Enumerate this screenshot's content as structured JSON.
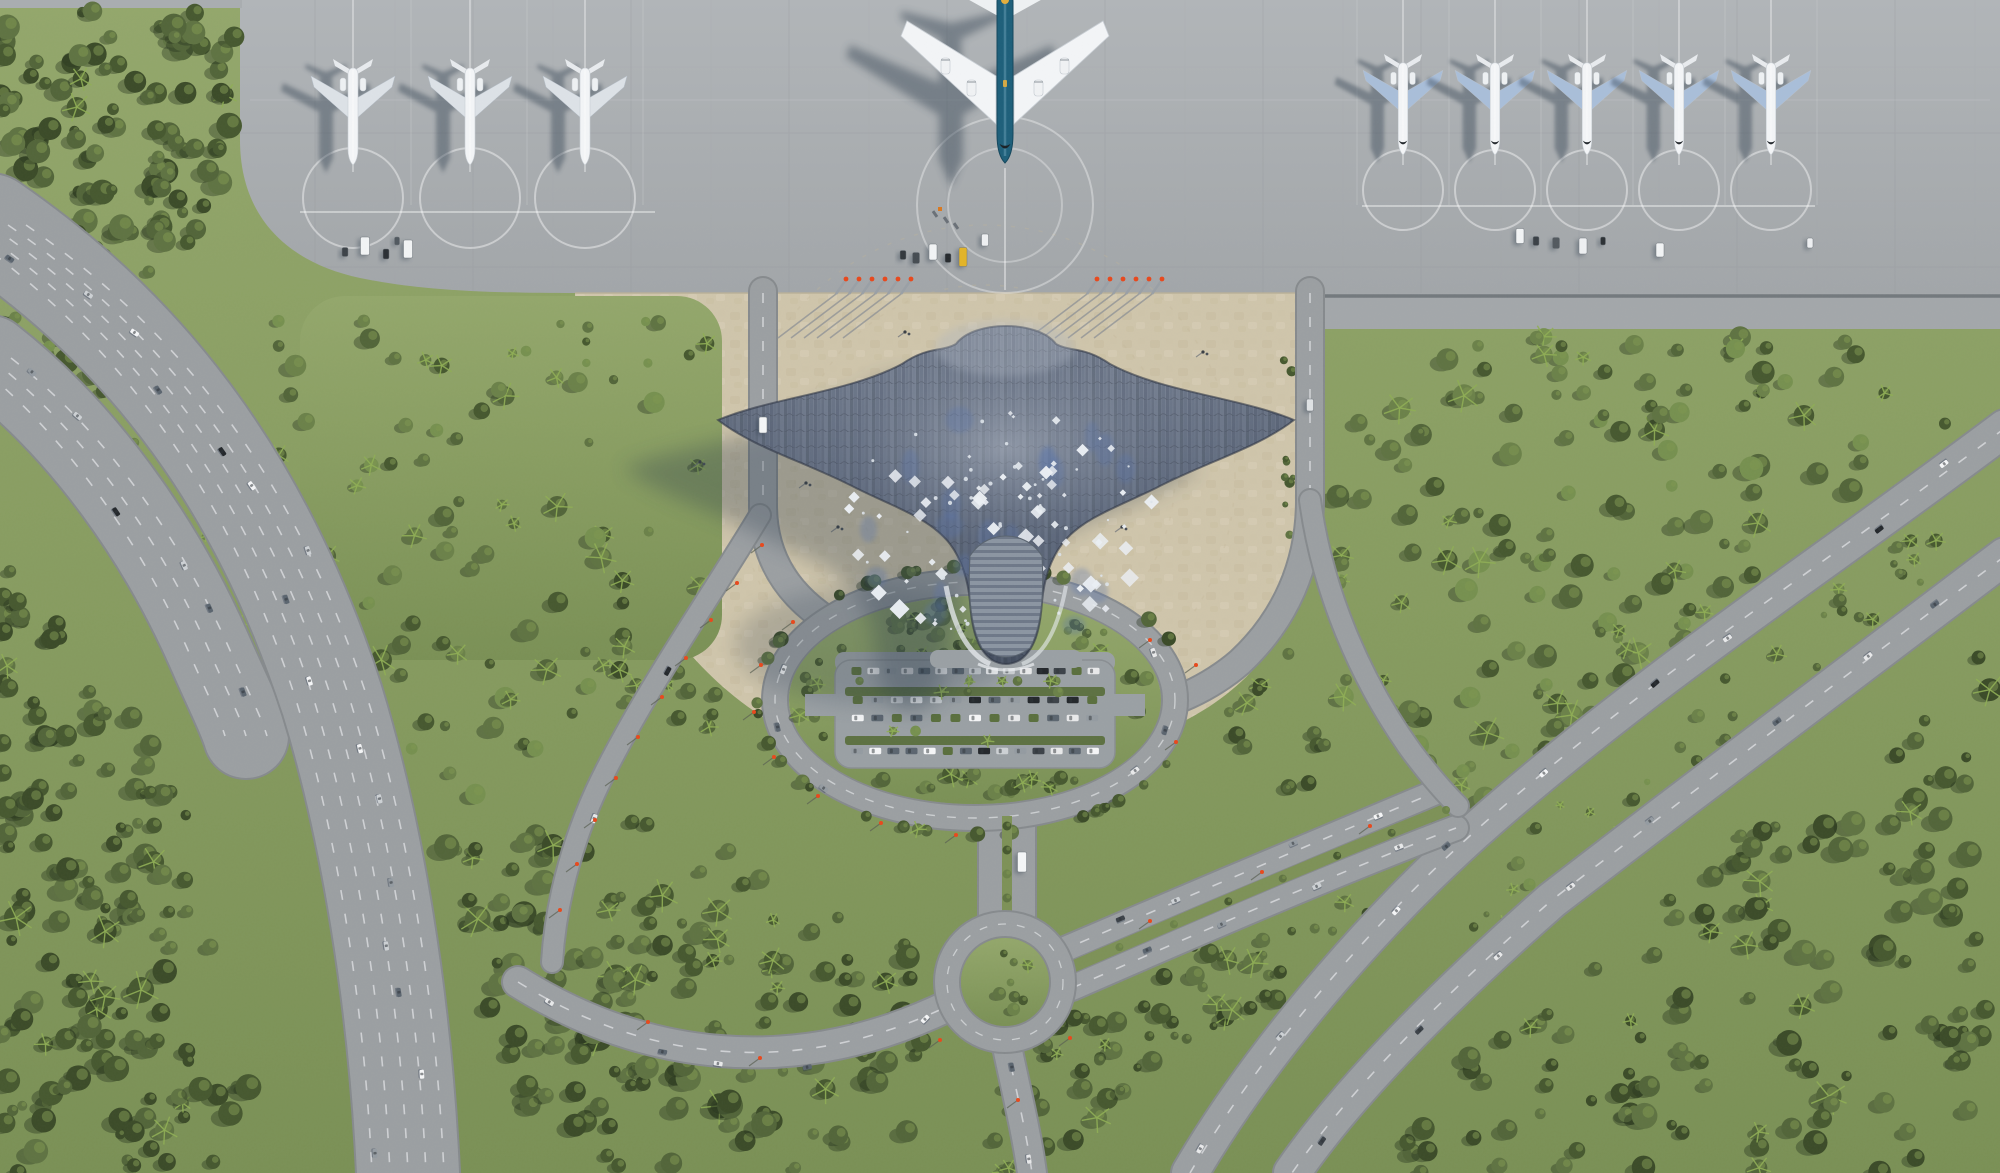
{
  "meta": {
    "type": "aerial-architectural-render",
    "subject": "manta-ray-shaped airport terminal, top-down view",
    "width": 2000,
    "height": 1173
  },
  "palette": {
    "apron": "#a9adb0",
    "apron_top": "#b0b4b7",
    "apron_line": "#93979a",
    "apron_joint": "#6b7176",
    "sand": "#cfc5ab",
    "sand_dark": "#c2b698",
    "grass": "#8ea266",
    "grass_dark": "#7d9157",
    "hedge": "#5a6f3d",
    "forest": [
      "#3b4b28",
      "#46582f",
      "#526539",
      "#5f7342",
      "#6b8149",
      "#76904f"
    ],
    "tree_shadow": "#26331c",
    "palm": "#8fae55",
    "road": "#9b9fa2",
    "road_edge": "#868a8d",
    "lane": "#e0e2e4",
    "roof_top": "#828b9b",
    "roof_bottom": "#475163",
    "roof_edge": "#2e3644",
    "roof_ribs": [
      "#4a5468",
      "#5d687c",
      "#525c6e",
      "#6b7689",
      "#45505f",
      "#596478"
    ],
    "roof_accent": "#5873ab",
    "diamond": "#ebeff4",
    "tail": "#8b95a2",
    "tail_rib": "#6e7888",
    "plane_white": "#f3f5f7",
    "wing_left_group": "#dde2e7",
    "wing_right_group": "#a9bed9",
    "big_fuselage": "#1d5f7a",
    "big_fuselage_hi": "#5b93ab",
    "big_gold": "#e4ae3c",
    "shadow": "#2c3a4c",
    "car_colors": [
      "#f5f6f7",
      "#cdd1d4",
      "#3c4248",
      "#23272b",
      "#949ba1",
      "#5b656f",
      "#e8e9ea"
    ],
    "lamp": "#e8481c",
    "yellow_vehicle": "#e3b427"
  },
  "apron": {
    "boundary_y": 293,
    "joint_line": {
      "x0": 1300,
      "x1": 2000,
      "y": 296
    },
    "large_aircraft": {
      "x": 1005,
      "nose_y": 163,
      "engines": 4
    },
    "small_aircraft_left": {
      "xs": [
        353,
        470,
        585
      ],
      "tail_y": 62,
      "scale": 1.0
    },
    "small_aircraft_right": {
      "xs": [
        1403,
        1495,
        1587,
        1679,
        1771
      ],
      "tail_y": 57,
      "scale": 0.95
    },
    "stand_lines": {
      "left_taxilane": [
        300,
        655,
        212
      ],
      "right_taxilane": [
        1362,
        1815,
        206
      ]
    },
    "jet_bridges": {
      "left_xs": [
        836,
        849,
        862,
        875,
        888,
        901
      ],
      "right_xs": [
        1087,
        1100,
        1113,
        1126,
        1139,
        1152
      ],
      "y": 294
    }
  },
  "terminal": {
    "head": [
      1005,
      320
    ],
    "wing_left": [
      718,
      420
    ],
    "wing_right": [
      1294,
      420
    ],
    "tail_tip": [
      1006,
      665
    ],
    "diamond_count": 68,
    "small_dot_count": 44,
    "accent_patch_count": 26,
    "scatter": {
      "cx": 1005,
      "cy": 525,
      "rx": 162,
      "ry": 114
    }
  },
  "landside": {
    "oval": {
      "cx": 975,
      "cy": 700,
      "rx": 200,
      "ry": 118,
      "ring_width": 24
    },
    "parking": {
      "x0": 848,
      "x1": 1102,
      "pad_x": 835,
      "pad_y": 660,
      "pad_w": 280,
      "pad_h": 108,
      "rows": [
        {
          "y": 671,
          "n": 15
        },
        {
          "y": 700,
          "n": 13
        },
        {
          "y": 718,
          "n": 13
        },
        {
          "y": 751,
          "n": 14
        }
      ]
    },
    "roundabout": {
      "cx": 1005,
      "cy": 982,
      "r": 58,
      "inner_r": 44
    }
  },
  "traffic_roads": [
    {
      "name": "highway-west-a",
      "pts": [
        [
          0,
          235
        ],
        [
          160,
          345
        ],
        [
          265,
          495
        ],
        [
          335,
          705
        ],
        [
          372,
          860
        ],
        [
          396,
          1010
        ],
        [
          406,
          1173
        ]
      ],
      "n": 16,
      "spread": 34
    },
    {
      "name": "highway-west-b",
      "pts": [
        [
          0,
          368
        ],
        [
          88,
          440
        ],
        [
          160,
          545
        ],
        [
          205,
          645
        ],
        [
          232,
          718
        ]
      ],
      "n": 6,
      "spread": 22
    },
    {
      "name": "highway-east-upper",
      "pts": [
        [
          2000,
          430
        ],
        [
          1830,
          560
        ],
        [
          1660,
          672
        ],
        [
          1492,
          818
        ],
        [
          1392,
          905
        ],
        [
          1270,
          1040
        ],
        [
          1192,
          1173
        ]
      ],
      "n": 9,
      "spread": 9
    },
    {
      "name": "highway-east-lower",
      "pts": [
        [
          2000,
          558
        ],
        [
          1838,
          682
        ],
        [
          1700,
          788
        ],
        [
          1552,
          900
        ],
        [
          1452,
          988
        ],
        [
          1352,
          1086
        ],
        [
          1292,
          1173
        ]
      ],
      "n": 8,
      "spread": 9
    },
    {
      "name": "avenue-ne-1",
      "pts": [
        [
          1062,
          950
        ],
        [
          1190,
          895
        ],
        [
          1320,
          838
        ],
        [
          1434,
          790
        ]
      ],
      "n": 4,
      "spread": 6
    },
    {
      "name": "avenue-ne-2",
      "pts": [
        [
          1076,
          986
        ],
        [
          1200,
          932
        ],
        [
          1330,
          874
        ],
        [
          1452,
          826
        ]
      ],
      "n": 4,
      "spread": 6
    },
    {
      "name": "approach-west",
      "pts": [
        [
          528,
          982
        ],
        [
          640,
          1052
        ],
        [
          780,
          1078
        ],
        [
          900,
          1052
        ],
        [
          944,
          1008
        ]
      ],
      "n": 5,
      "spread": 7
    },
    {
      "name": "exit-south",
      "pts": [
        [
          1008,
          1046
        ],
        [
          1020,
          1104
        ],
        [
          1030,
          1173
        ]
      ],
      "n": 2,
      "spread": 6
    },
    {
      "name": "ring-west",
      "pts": [
        [
          800,
          640
        ],
        [
          776,
          700
        ],
        [
          790,
          762
        ],
        [
          850,
          808
        ]
      ],
      "n": 3,
      "spread": 5
    },
    {
      "name": "ring-east",
      "pts": [
        [
          1150,
          636
        ],
        [
          1172,
          700
        ],
        [
          1154,
          762
        ],
        [
          1096,
          806
        ]
      ],
      "n": 3,
      "spread": 5
    },
    {
      "name": "diagonal-west",
      "pts": [
        [
          744,
          540
        ],
        [
          680,
          640
        ],
        [
          616,
          760
        ],
        [
          572,
          880
        ]
      ],
      "n": 2,
      "spread": 5
    }
  ],
  "service_vehicles": [
    [
      365,
      246,
      9,
      18,
      "#f2f4f5"
    ],
    [
      345,
      252,
      6,
      9,
      "#3c4248"
    ],
    [
      386,
      254,
      6,
      10,
      "#2a2f34"
    ],
    [
      408,
      249,
      9,
      18,
      "#f2f4f5"
    ],
    [
      397,
      241,
      5,
      8,
      "#50585f"
    ],
    [
      903,
      255,
      6,
      9,
      "#33383d"
    ],
    [
      916,
      258,
      7,
      11,
      "#454c52"
    ],
    [
      933,
      252,
      8,
      16,
      "#f2f4f5"
    ],
    [
      948,
      258,
      6,
      9,
      "#262a2e"
    ],
    [
      963,
      257,
      8,
      19,
      "#e3b427"
    ],
    [
      985,
      240,
      7,
      12,
      "#eef0f2"
    ],
    [
      1520,
      236,
      8,
      15,
      "#f2f4f5"
    ],
    [
      1536,
      241,
      6,
      9,
      "#3a4046"
    ],
    [
      1556,
      243,
      7,
      11,
      "#52595f"
    ],
    [
      1583,
      246,
      8,
      16,
      "#eef0f2"
    ],
    [
      1603,
      241,
      5,
      8,
      "#2c3135"
    ],
    [
      1660,
      250,
      8,
      14,
      "#f2f4f5"
    ],
    [
      1810,
      243,
      6,
      10,
      "#eef0f2"
    ],
    [
      763,
      425,
      8,
      16,
      "#f4f6f7"
    ],
    [
      1310,
      405,
      7,
      12,
      "#dfe2e4"
    ],
    [
      1022,
      862,
      9,
      20,
      "#f4f6f7"
    ]
  ],
  "baggage_carts": [
    [
      935,
      214
    ],
    [
      946,
      220
    ],
    [
      956,
      226
    ]
  ],
  "orange_cart": [
    940,
    209
  ],
  "lamps": [
    [
      762,
      545
    ],
    [
      737,
      583
    ],
    [
      711,
      620
    ],
    [
      686,
      658
    ],
    [
      662,
      697
    ],
    [
      638,
      737
    ],
    [
      616,
      778
    ],
    [
      595,
      820
    ],
    [
      577,
      864
    ],
    [
      560,
      910
    ],
    [
      956,
      835
    ],
    [
      881,
      823
    ],
    [
      818,
      796
    ],
    [
      774,
      757
    ],
    [
      754,
      712
    ],
    [
      761,
      665
    ],
    [
      793,
      622
    ],
    [
      1176,
      742
    ],
    [
      1196,
      665
    ],
    [
      1150,
      640
    ],
    [
      1150,
      921
    ],
    [
      1262,
      872
    ],
    [
      1370,
      826
    ],
    [
      648,
      1022
    ],
    [
      760,
      1058
    ],
    [
      940,
      1040
    ],
    [
      1070,
      1038
    ],
    [
      1018,
      1100
    ]
  ],
  "people": [
    [
      905,
      332
    ],
    [
      868,
      392
    ],
    [
      792,
      441
    ],
    [
      806,
      483
    ],
    [
      936,
      470
    ],
    [
      958,
      502
    ],
    [
      838,
      527
    ],
    [
      700,
      462
    ],
    [
      1103,
      392
    ],
    [
      1148,
      470
    ],
    [
      1203,
      352
    ],
    [
      1122,
      527
    ]
  ],
  "vegetation": [
    {
      "name": "forest-upper-left",
      "poly": [
        [
          0,
          10
        ],
        [
          238,
          10
        ],
        [
          238,
          150
        ],
        [
          196,
          246
        ],
        [
          120,
          360
        ],
        [
          40,
          470
        ],
        [
          0,
          520
        ]
      ],
      "n": 140,
      "rmin": 5,
      "rmax": 13,
      "dark": true,
      "palm": 0.05
    },
    {
      "name": "forest-west-lower",
      "poly": [
        [
          0,
          540
        ],
        [
          95,
          650
        ],
        [
          185,
          800
        ],
        [
          235,
          950
        ],
        [
          250,
          1080
        ],
        [
          245,
          1173
        ],
        [
          0,
          1173
        ]
      ],
      "n": 150,
      "rmin": 5,
      "rmax": 13,
      "dark": true,
      "palm": 0.06
    },
    {
      "name": "grass-mid",
      "poly": [
        [
          255,
          320
        ],
        [
          700,
          320
        ],
        [
          735,
          430
        ],
        [
          720,
          560
        ],
        [
          650,
          655
        ],
        [
          540,
          755
        ],
        [
          430,
          850
        ],
        [
          345,
          745
        ],
        [
          280,
          560
        ],
        [
          255,
          430
        ]
      ],
      "n": 85,
      "rmin": 4,
      "rmax": 11,
      "dark": false,
      "palm": 0.25
    },
    {
      "name": "forest-south",
      "poly": [
        [
          440,
          845
        ],
        [
          610,
          810
        ],
        [
          770,
          862
        ],
        [
          900,
          930
        ],
        [
          935,
          1040
        ],
        [
          905,
          1173
        ],
        [
          565,
          1173
        ],
        [
          480,
          1010
        ]
      ],
      "n": 150,
      "rmin": 5,
      "rmax": 13,
      "dark": true,
      "palm": 0.12
    },
    {
      "name": "forest-right-triangle",
      "poly": [
        [
          1335,
          332
        ],
        [
          1980,
          332
        ],
        [
          1980,
          428
        ],
        [
          1760,
          600
        ],
        [
          1560,
          762
        ],
        [
          1430,
          860
        ],
        [
          1345,
          740
        ],
        [
          1335,
          470
        ]
      ],
      "n": 150,
      "rmin": 5,
      "rmax": 12,
      "dark": false,
      "palm": 0.15
    },
    {
      "name": "forest-se-corner",
      "poly": [
        [
          1380,
          1173
        ],
        [
          1470,
          1030
        ],
        [
          1620,
          930
        ],
        [
          1990,
          640
        ],
        [
          1990,
          1173
        ]
      ],
      "n": 130,
      "rmin": 5,
      "rmax": 13,
      "dark": true,
      "palm": 0.1
    },
    {
      "name": "forest-between-avenue",
      "poly": [
        [
          1005,
          1060
        ],
        [
          1080,
          1000
        ],
        [
          1230,
          915
        ],
        [
          1360,
          865
        ],
        [
          1415,
          910
        ],
        [
          1280,
          1005
        ],
        [
          1120,
          1095
        ],
        [
          1060,
          1173
        ],
        [
          975,
          1173
        ]
      ],
      "n": 70,
      "rmin": 4,
      "rmax": 11,
      "dark": true,
      "palm": 0.15
    },
    {
      "name": "median-right",
      "poly": [
        [
          1985,
          480
        ],
        [
          1820,
          600
        ],
        [
          1650,
          725
        ],
        [
          1520,
          840
        ],
        [
          1450,
          935
        ],
        [
          1490,
          945
        ],
        [
          1600,
          850
        ],
        [
          1760,
          715
        ],
        [
          1900,
          605
        ],
        [
          1992,
          528
        ]
      ],
      "n": 35,
      "rmin": 3,
      "rmax": 7,
      "dark": false,
      "palm": 0.2
    },
    {
      "name": "median-left",
      "poly": [
        [
          0,
          305
        ],
        [
          120,
          390
        ],
        [
          225,
          560
        ],
        [
          268,
          700
        ],
        [
          238,
          742
        ],
        [
          185,
          610
        ],
        [
          80,
          440
        ],
        [
          0,
          372
        ]
      ],
      "n": 30,
      "rmin": 3,
      "rmax": 7,
      "dark": false,
      "palm": 0.2
    },
    {
      "name": "corner-left",
      "poly": [
        [
          578,
          565
        ],
        [
          690,
          602
        ],
        [
          755,
          682
        ],
        [
          700,
          742
        ],
        [
          606,
          700
        ],
        [
          578,
          622
        ]
      ],
      "n": 14,
      "rmin": 4,
      "rmax": 9,
      "dark": true,
      "palm": 0.2
    },
    {
      "name": "corner-right",
      "poly": [
        [
          1225,
          655
        ],
        [
          1320,
          690
        ],
        [
          1352,
          768
        ],
        [
          1300,
          806
        ],
        [
          1222,
          745
        ]
      ],
      "n": 12,
      "rmin": 4,
      "rmax": 9,
      "dark": true,
      "palm": 0.2
    },
    {
      "name": "tree-line-right-road",
      "poly": [
        [
          1282,
          310
        ],
        [
          1296,
          310
        ],
        [
          1296,
          700
        ],
        [
          1282,
          700
        ]
      ],
      "n": 14,
      "rmin": 3,
      "rmax": 6,
      "dark": true,
      "palm": 0.0
    }
  ],
  "oval_interior_trees": {
    "n": 65,
    "skip_rect": [
      828,
      655,
      1122,
      772
    ],
    "palm": 0.2
  },
  "ring_edge_trees": {
    "n": 36
  },
  "roundabout_trees": {
    "n": 8
  },
  "avenue_median_trees": {
    "n": 8
  }
}
